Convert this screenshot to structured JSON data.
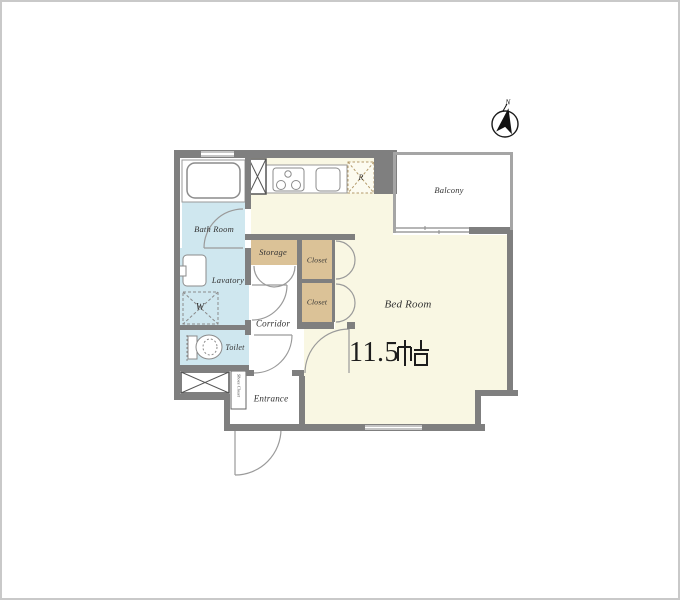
{
  "floor_plan": {
    "title": "apartment-floor-plan",
    "compass": {
      "north_label": "N"
    },
    "rooms": {
      "bath": "Bath Room",
      "lavatory": "Lavatory",
      "toilet": "Toilet",
      "storage": "Storage",
      "closet_upper": "Closet",
      "closet_lower": "Closet",
      "corridor": "Corridor",
      "entrance": "Entrance",
      "shoes_closet": "Shoes Closet",
      "bedroom": "Bed Room",
      "balcony": "Balcony"
    },
    "bedroom_size": {
      "value": "11.5",
      "unit": "帖",
      "full": "11.5帖"
    },
    "fixtures": {
      "refrigerator_label": "R",
      "washing_machine_label": "W"
    },
    "colors": {
      "wall": "#7f7f7f",
      "light_wall": "#a5a5a5",
      "bedroom_floor": "#f9f7e3",
      "wet_area_floor": "#cfe7ef",
      "closet_floor": "#dbc297",
      "fixture_line": "#8b8b8b",
      "door_arc": "#9a9a9a"
    }
  }
}
